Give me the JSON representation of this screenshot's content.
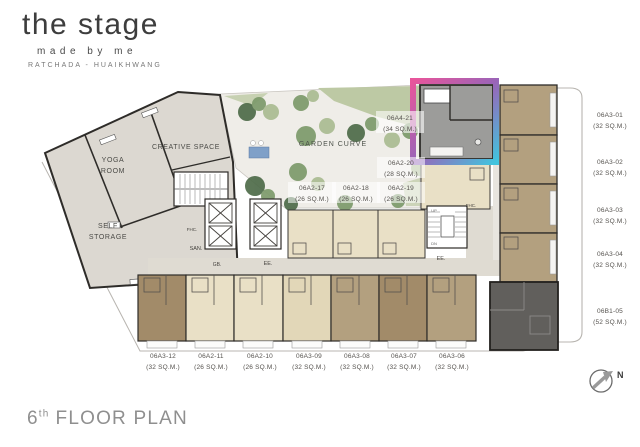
{
  "brand": {
    "logo": "the stage",
    "tagline": "made by me",
    "location": "RATCHADA - HUAIKHWANG"
  },
  "page_title": {
    "number": "6",
    "suffix": "th",
    "text": "FLOOR PLAN"
  },
  "compass": {
    "label": "N"
  },
  "rooms": {
    "yoga_line1": "YOGA",
    "yoga_line2": "ROOM",
    "creative": "CREATIVE SPACE",
    "storage_line1": "SELF",
    "storage_line2": "STORAGE",
    "garden": "GARDEN CURVE"
  },
  "plan_marks": {
    "san": "SAN.",
    "gb": "GB.",
    "ee_core": "EE.",
    "ee_stair": "EE.",
    "fhc_core": "FHC.",
    "fhc_stair": "FHC.",
    "up": "UP",
    "dn": "DN"
  },
  "units": {
    "highlighted": {
      "id": "06A4-21",
      "area": "(34 SQ.M.)"
    },
    "garden_row": [
      {
        "id": "06A2-17",
        "area": "(26 SQ.M.)"
      },
      {
        "id": "06A2-18",
        "area": "(26 SQ.M.)"
      },
      {
        "id": "06A2-19",
        "area": "(26 SQ.M.)"
      },
      {
        "id": "06A2-20",
        "area": "(28 SQ.M.)"
      }
    ],
    "right_column": [
      {
        "id": "06A3-01",
        "area": "(32 SQ.M.)"
      },
      {
        "id": "06A3-02",
        "area": "(32 SQ.M.)"
      },
      {
        "id": "06A3-03",
        "area": "(32 SQ.M.)"
      },
      {
        "id": "06A3-04",
        "area": "(32 SQ.M.)"
      },
      {
        "id": "06B1-05",
        "area": "(52 SQ.M.)"
      }
    ],
    "bottom_row": [
      {
        "id": "06A3-12",
        "area": "(32 SQ.M.)"
      },
      {
        "id": "06A2-11",
        "area": "(26 SQ.M.)"
      },
      {
        "id": "06A2-10",
        "area": "(26 SQ.M.)"
      },
      {
        "id": "06A3-09",
        "area": "(32 SQ.M.)"
      },
      {
        "id": "06A3-08",
        "area": "(32 SQ.M.)"
      },
      {
        "id": "06A3-07",
        "area": "(32 SQ.M.)"
      },
      {
        "id": "06A3-06",
        "area": "(32 SQ.M.)"
      }
    ]
  },
  "colors": {
    "wall": "#2e2c29",
    "amenity_fill": "#dcd8d1",
    "corridor_fill": "#dfdbd2",
    "core_fill": "#ffffff",
    "beige_unit": "#e9e0c6",
    "beige_unit_alt": "#e2d7b8",
    "tan_unit": "#b3a07f",
    "tan_unit_dark": "#a28b69",
    "dark_unit": "#615f5c",
    "highlight_unit": "#9c9c9a",
    "garden_bg": "#efede8",
    "lawn": "#bdc9a4",
    "bush_dark": "#4e6b49",
    "bush_mid": "#7d9a6b",
    "bush_light": "#aabc92",
    "water": "#7fa0c8",
    "grad_start": "#e8559b",
    "grad_mid": "#9a64b8",
    "grad_end": "#41c4de"
  }
}
